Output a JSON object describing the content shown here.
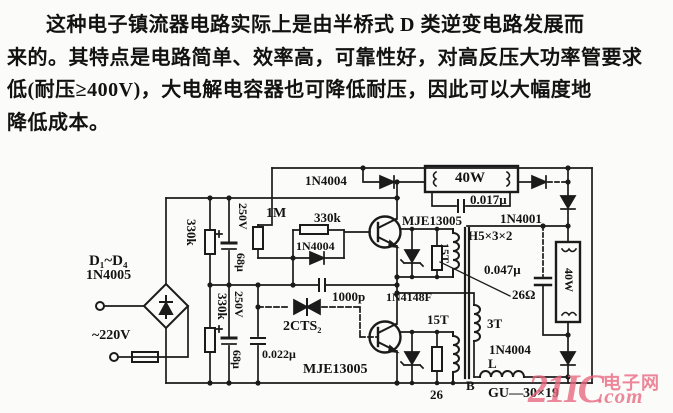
{
  "paragraph": {
    "lines": [
      "这种电子镇流器电路实际上是由半桥式 D 类逆变电路发展而",
      "来的。其特点是电路简单、效率高，可靠性好，对高反压大功率管要求",
      "低(耐压≥400V)，大电解电容器也可降低耐压，因此可以大幅度地",
      "降低成本。"
    ]
  },
  "schematic": {
    "labels": {
      "d_top_diode": "1N4004",
      "lamp_h": "40W",
      "cap_017": "0.017μ",
      "d_1n4001": "1N4001",
      "bridge_name": "D₁~D₄",
      "bridge_part": "1N4005",
      "mains": "~220V",
      "r_330k_top": "330k",
      "c_250v_top": "250V",
      "c_68u_top": "68μ",
      "r_1m": "1M",
      "r_330k_mid": "330k",
      "d_mid": "1N4004",
      "cap_1000p": "1000p",
      "q1": "MJE13005",
      "core_size": "H5×3×2",
      "w_15t_top": "15T",
      "cap_047": "0.047μ",
      "r_26ohm": "26Ω",
      "r_330k_bot": "330k",
      "c_250v_bot": "250V",
      "c_68u_bot": "68μ",
      "diac": "2CTS₂",
      "cap_022": "0.022μ",
      "q2": "MJE13005",
      "d_4148": "1N4148F",
      "w_15t_bot": "15T",
      "w_3t": "3T",
      "d_out": "1N4004",
      "ind_l": "L",
      "r_26_bot": "26",
      "core_b": "B",
      "core_type": "GU—30×19",
      "lamp_v": "40W"
    }
  },
  "watermark": {
    "brand": "21IC",
    "cn": "电子网",
    "dot_com": ".com",
    "color": "#e8677d"
  }
}
